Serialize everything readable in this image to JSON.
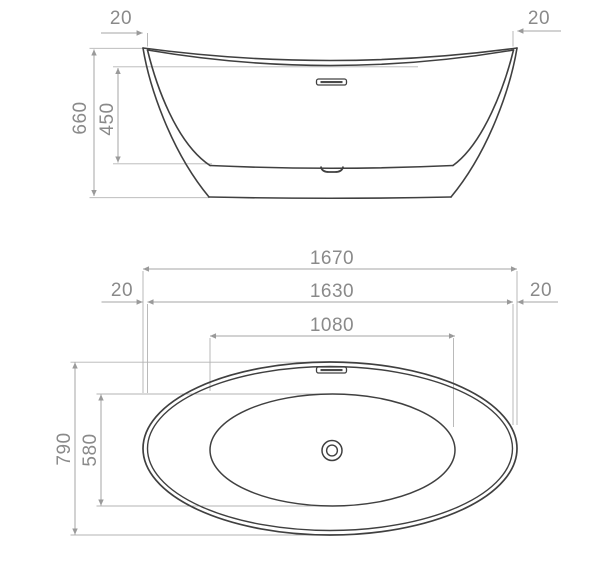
{
  "drawing": {
    "type": "technical-drawing",
    "subject": "freestanding bathtub, elevation and plan views",
    "units_shown": "mm",
    "side_view": {
      "dim_rim_thickness_left": "20",
      "dim_rim_thickness_right": "20",
      "dim_overall_height": "660",
      "dim_internal_depth": "450"
    },
    "plan_view": {
      "dim_overall_length": "1670",
      "dim_rim_inner_length": "1630",
      "dim_basin_length": "1080",
      "dim_rim_thickness_left": "20",
      "dim_rim_thickness_right": "20",
      "dim_overall_width": "790",
      "dim_basin_width": "580"
    },
    "colors": {
      "outline": "#404040",
      "dimension_lines": "#a6a6a6",
      "dimension_text": "#8a8a8a",
      "background": "#ffffff"
    }
  }
}
